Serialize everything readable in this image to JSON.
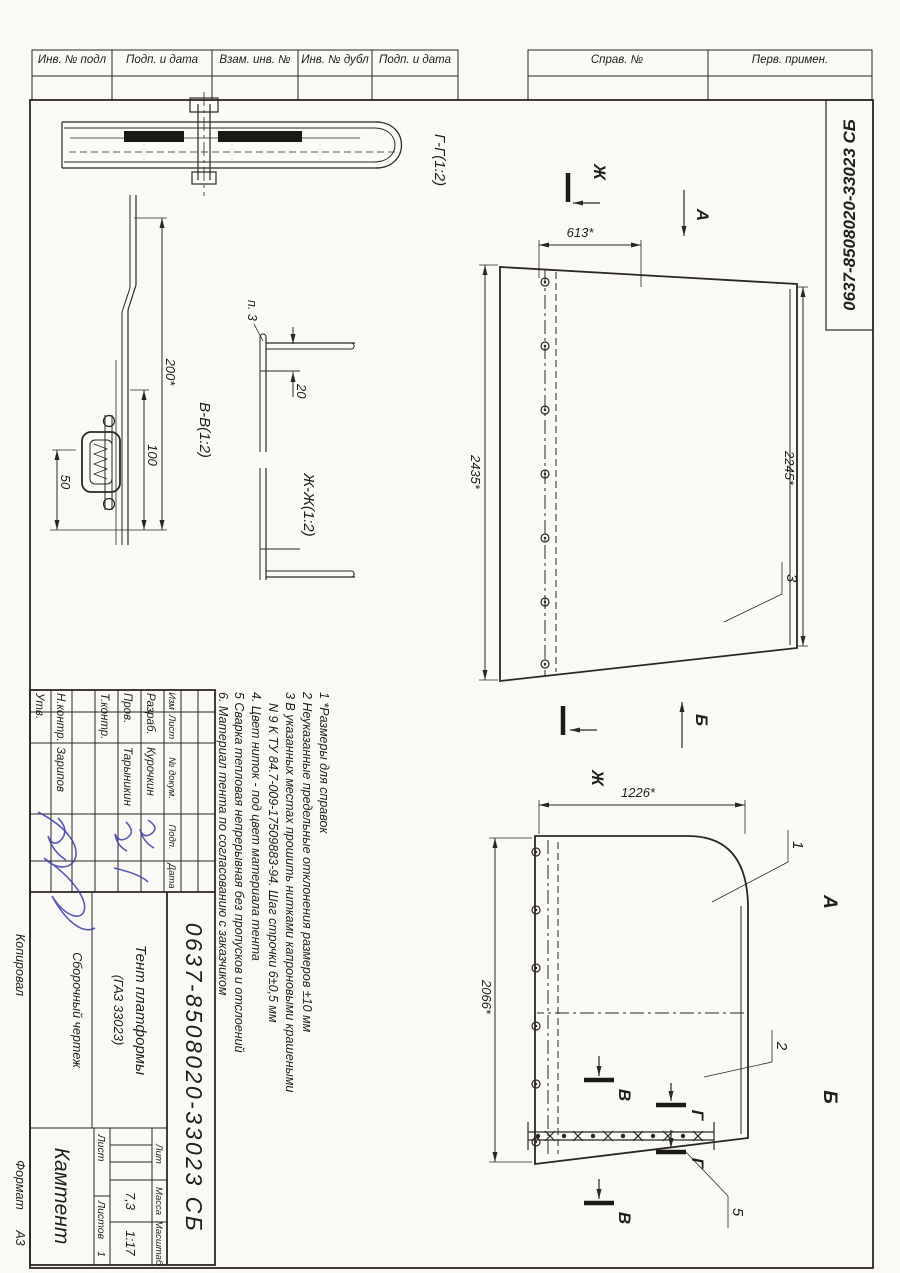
{
  "document": {
    "corner_number": "0637-8508020-33023 СБ"
  },
  "edge_stamps": {
    "perv_primen": "Перв. примен.",
    "sprav_no": "Справ. №",
    "podp_i_data_1": "Подп. и дата",
    "inv_no_dubl": "Инв. № дубл",
    "vzam_inv_no": "Взам. инв. №",
    "podp_i_data_2": "Подп. и дата",
    "inv_no_podl": "Инв. № подл"
  },
  "views": {
    "section_gg_label": "Г-Г(1:2)",
    "section_vv_label": "В-В(1:2)",
    "section_jj_label": "Ж-Ж(1:2)",
    "view_a_label": "А",
    "view_b_label": "Б",
    "letter_j": "Ж",
    "letter_v": "В",
    "letter_g": "Г",
    "letter_a": "А",
    "letter_b": "Б",
    "pos_ref": "п. 3"
  },
  "dimensions": {
    "top_width": "613*",
    "left_height": "2435*",
    "right_height": "2245*",
    "front_width": "1226*",
    "front_height": "2066*",
    "edge_200": "200*",
    "edge_100": "100",
    "edge_50": "50",
    "hem_20": "20"
  },
  "callouts": {
    "pos1": "1",
    "pos2": "2",
    "pos3": "3",
    "pos5": "5"
  },
  "notes": {
    "lines": [
      "1 *Размеры для справок",
      "2 Неуказанные предельные отклонения размеров ±10 мм",
      "3 В указанных местах прошить нитками капроновыми крашеными",
      "N 9 К ТУ 84.7-009-17509883-94. Шаг строчки 6±0,5 мм",
      "4. Цвет ниток - под цвет материала тента",
      "5 Сварка тепловая непрерывная без пропусков и отслоений",
      "6. Материал тента по согласованию с заказчиком"
    ]
  },
  "title_block": {
    "doc_number": "0637-8508020-33023 СБ",
    "product_name_line1": "Тент платформы",
    "product_name_line2": "(ГАЗ 33023)",
    "doc_type": "Сборочный чертеж",
    "company": "Камтент",
    "header": {
      "izm": "Изм",
      "list": "Лист",
      "doc_no": "№ докум.",
      "podp": "Подп.",
      "data": "Дата"
    },
    "roles": {
      "razrab": "Разраб.",
      "prov": "Пров.",
      "tkontr": "Т.контр.",
      "nkontr": "Н.контр.",
      "utv": "Утв."
    },
    "names": {
      "razrab": "Курочкин",
      "prov": "Тарыникин",
      "nkontr": "Зарипов"
    },
    "lit_label": "Лит",
    "mass_label": "Масса",
    "scale_label": "Масштаб",
    "mass_value": "7,3",
    "scale_value": "1:17",
    "sheet_label": "Лист",
    "sheets_label": "Листов",
    "sheets_value": "1"
  },
  "footer": {
    "kopiroval": "Копировал",
    "format_label": "Формат",
    "format_value": "А3"
  }
}
